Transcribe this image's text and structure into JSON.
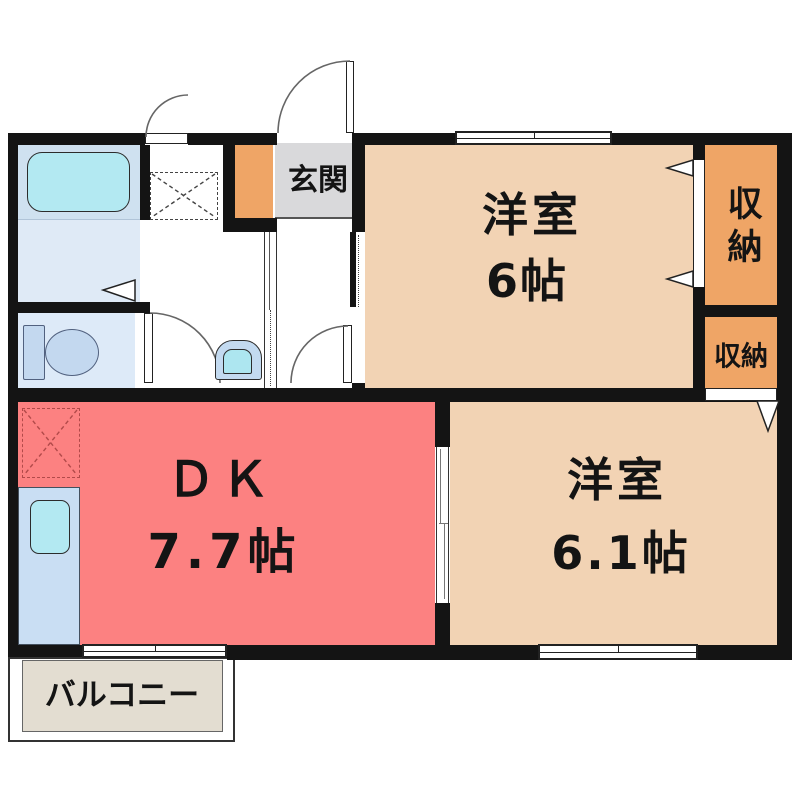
{
  "plan": {
    "rooms": {
      "entrance": {
        "label": "玄関",
        "color": "#d9d9db"
      },
      "bedroom6": {
        "label": "洋室",
        "size": "6帖",
        "color": "#f2d3b4"
      },
      "closet_upper": {
        "label": "収納",
        "color": "#efa566"
      },
      "closet_lower": {
        "label": "収納",
        "color": "#efa566"
      },
      "dining_kitchen": {
        "label": "ＤＫ",
        "size": "7.7帖",
        "color": "#fc8181"
      },
      "bedroom61": {
        "label": "洋室",
        "size": "6.1帖",
        "color": "#f2d3b4"
      },
      "balcony": {
        "label": "バルコニー",
        "color": "#e3ddd1"
      },
      "bathroom": {
        "color": "#cfe1f0"
      },
      "washroom": {
        "color": "#dfeaf6"
      },
      "toilet_room": {
        "color": "#ddeaf8"
      }
    },
    "fixtures": [
      "bathtub-icon",
      "toilet-icon",
      "hand-basin-icon",
      "washing-machine-pad-icon",
      "refrigerator-pad-icon",
      "kitchen-counter",
      "kitchen-sink-icon",
      "door-arc-icon",
      "sliding-door-icon",
      "sliding-window-icon",
      "folding-door-triangle-icon"
    ],
    "colors": {
      "wall": "#141414",
      "bathtub": "#b3e9f2",
      "kitchen_counter": "#c9def3",
      "toilet_fixture": "#c3d8ef",
      "background": "#ffffff"
    }
  }
}
